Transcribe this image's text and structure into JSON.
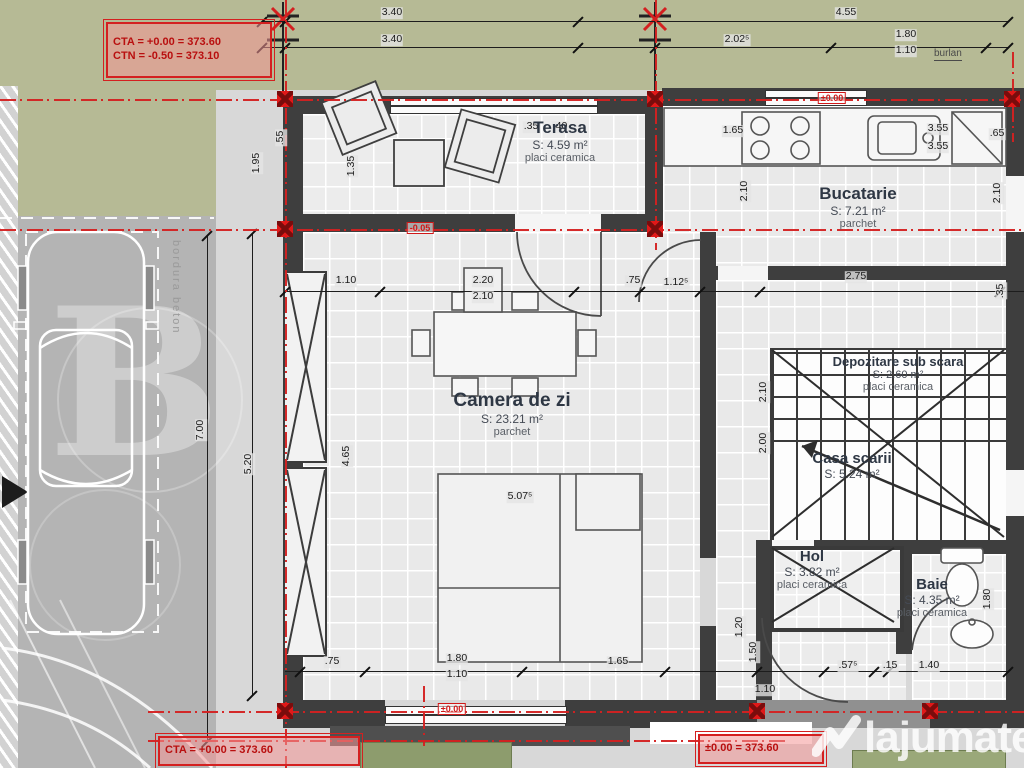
{
  "watermark": {
    "brand": "lajumate",
    "tld": ".ro",
    "big_letter": "B"
  },
  "site": {
    "curb_label": "bordura beton",
    "downspout_label": "burlan"
  },
  "level_boxes": {
    "top_left_line1": "CTA = +0.00 = 373.60",
    "top_left_line2": "CTN = -0.50 = 373.10",
    "bottom_left": "CTA = +0.00 = 373.60",
    "bottom_right": "±0.00 = 373.60"
  },
  "level_tags": [
    {
      "t": "±0.00",
      "x": 832,
      "y": 98
    },
    {
      "t": "-0.05",
      "x": 420,
      "y": 228
    },
    {
      "t": "±0.00",
      "x": 452,
      "y": 709
    }
  ],
  "rooms": [
    {
      "name": "Terasa",
      "area": "S: 4.59 m²",
      "finish": "placi ceramica",
      "x": 560,
      "y": 118,
      "cls": "big"
    },
    {
      "name": "Bucatarie",
      "area": "S: 7.21 m²",
      "finish": "parchet",
      "x": 858,
      "y": 184,
      "cls": "big"
    },
    {
      "name": "Camera de zi",
      "area": "S: 23.21 m²",
      "finish": "parchet",
      "x": 512,
      "y": 390,
      "cls": "xl"
    },
    {
      "name": "Depozitare sub scara",
      "area": "S: 2.60 m²",
      "finish": "placi ceramica",
      "x": 898,
      "y": 354,
      "cls": "sm"
    },
    {
      "name": "Casa scarii",
      "area": "S: 5.24 m²",
      "finish": "",
      "x": 852,
      "y": 450,
      "cls": "md"
    },
    {
      "name": "Hol",
      "area": "S: 3.82 m²",
      "finish": "placi ceramica",
      "x": 812,
      "y": 548,
      "cls": "md"
    },
    {
      "name": "Baie",
      "area": "S: 4.35 m²",
      "finish": "placi ceramica",
      "x": 932,
      "y": 576,
      "cls": "md"
    }
  ],
  "dimensions": [
    {
      "t": "3.40",
      "x": 392,
      "y": 13
    },
    {
      "t": "4.55",
      "x": 846,
      "y": 13
    },
    {
      "t": "3.40",
      "x": 392,
      "y": 40
    },
    {
      "t": "2.02⁵",
      "x": 737,
      "y": 40
    },
    {
      "t": "1.80",
      "x": 906,
      "y": 35
    },
    {
      "t": "1.10",
      "x": 906,
      "y": 51
    },
    {
      "t": ".35",
      "x": 531,
      "y": 127
    },
    {
      "t": ".40",
      "x": 560,
      "y": 127
    },
    {
      "t": "1.95",
      "x": 257,
      "y": 163,
      "v": true
    },
    {
      "t": ".55",
      "x": 281,
      "y": 138,
      "v": true
    },
    {
      "t": "1.35",
      "x": 352,
      "y": 166,
      "v": true
    },
    {
      "t": "1.10",
      "x": 346,
      "y": 281
    },
    {
      "t": "2.20",
      "x": 483,
      "y": 281
    },
    {
      "t": "2.10",
      "x": 483,
      "y": 297
    },
    {
      "t": ".75",
      "x": 633,
      "y": 281
    },
    {
      "t": "1.12⁵",
      "x": 676,
      "y": 283
    },
    {
      "t": "2.75",
      "x": 856,
      "y": 277
    },
    {
      "t": ".35",
      "x": 1001,
      "y": 291,
      "v": true
    },
    {
      "t": "1.65",
      "x": 733,
      "y": 131
    },
    {
      "t": "3.55",
      "x": 938,
      "y": 129
    },
    {
      "t": "3.55",
      "x": 938,
      "y": 147
    },
    {
      "t": ".65",
      "x": 997,
      "y": 134
    },
    {
      "t": "2.10",
      "x": 745,
      "y": 191,
      "v": true
    },
    {
      "t": "2.10",
      "x": 998,
      "y": 193,
      "v": true
    },
    {
      "t": "2.10",
      "x": 764,
      "y": 392,
      "v": true
    },
    {
      "t": "2.00",
      "x": 764,
      "y": 443,
      "v": true
    },
    {
      "t": "4.65",
      "x": 347,
      "y": 456,
      "v": true
    },
    {
      "t": "5.07⁵",
      "x": 520,
      "y": 497
    },
    {
      "t": "1.20",
      "x": 740,
      "y": 627,
      "v": true
    },
    {
      "t": "1.50",
      "x": 754,
      "y": 652,
      "v": true
    },
    {
      "t": "1.80",
      "x": 988,
      "y": 599,
      "v": true
    },
    {
      "t": ".75",
      "x": 332,
      "y": 662
    },
    {
      "t": "1.80",
      "x": 457,
      "y": 659
    },
    {
      "t": "1.10",
      "x": 457,
      "y": 675
    },
    {
      "t": "1.65",
      "x": 618,
      "y": 662
    },
    {
      "t": ".57⁵",
      "x": 848,
      "y": 666
    },
    {
      "t": ".15",
      "x": 890,
      "y": 666
    },
    {
      "t": "1.40",
      "x": 929,
      "y": 666
    },
    {
      "t": "1.10",
      "x": 765,
      "y": 690
    },
    {
      "t": "7.00",
      "x": 201,
      "y": 430,
      "v": true
    },
    {
      "t": "5.20",
      "x": 249,
      "y": 464,
      "v": true
    }
  ],
  "ticks": [
    {
      "x": 262,
      "y": 22
    },
    {
      "x": 285,
      "y": 22
    },
    {
      "x": 578,
      "y": 22
    },
    {
      "x": 1008,
      "y": 22
    },
    {
      "x": 262,
      "y": 48
    },
    {
      "x": 285,
      "y": 48
    },
    {
      "x": 578,
      "y": 48
    },
    {
      "x": 655,
      "y": 48
    },
    {
      "x": 831,
      "y": 48
    },
    {
      "x": 986,
      "y": 48
    },
    {
      "x": 1008,
      "y": 48
    },
    {
      "x": 285,
      "y": 292
    },
    {
      "x": 380,
      "y": 292
    },
    {
      "x": 574,
      "y": 292
    },
    {
      "x": 640,
      "y": 292
    },
    {
      "x": 700,
      "y": 292
    },
    {
      "x": 760,
      "y": 292
    },
    {
      "x": 1000,
      "y": 292
    },
    {
      "x": 300,
      "y": 672
    },
    {
      "x": 365,
      "y": 672
    },
    {
      "x": 522,
      "y": 672
    },
    {
      "x": 665,
      "y": 672
    },
    {
      "x": 757,
      "y": 672
    },
    {
      "x": 824,
      "y": 672
    },
    {
      "x": 874,
      "y": 672
    },
    {
      "x": 888,
      "y": 672
    },
    {
      "x": 1008,
      "y": 672
    },
    {
      "x": 207,
      "y": 236
    },
    {
      "x": 207,
      "y": 742
    },
    {
      "x": 252,
      "y": 234
    },
    {
      "x": 252,
      "y": 696
    }
  ],
  "axis_markers": [
    {
      "x": 285,
      "y": 99
    },
    {
      "x": 655,
      "y": 99
    },
    {
      "x": 1012,
      "y": 99
    },
    {
      "x": 285,
      "y": 229
    },
    {
      "x": 655,
      "y": 229
    },
    {
      "x": 285,
      "y": 711
    },
    {
      "x": 757,
      "y": 711
    },
    {
      "x": 930,
      "y": 711
    }
  ],
  "colors": {
    "accent_red": "#d42020",
    "wall": "#3e3e3e",
    "olive": "#b6ba95"
  }
}
